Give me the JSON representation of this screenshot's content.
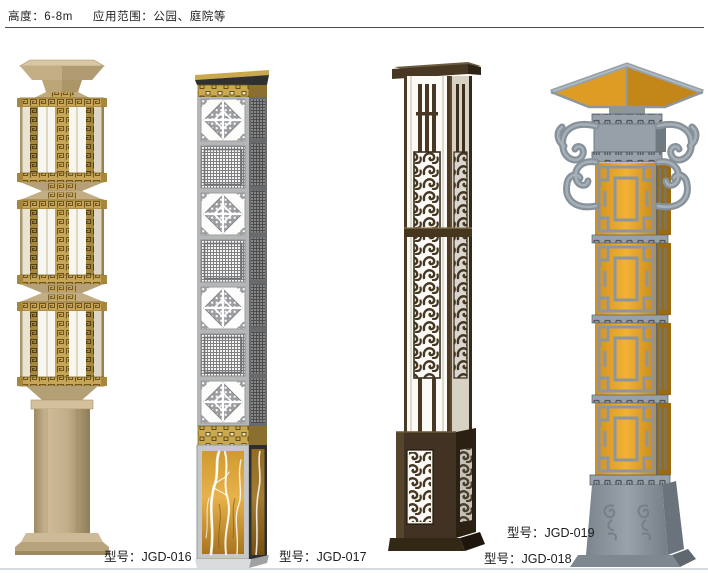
{
  "page": {
    "header": {
      "spec_text_height": "高度：6-8m",
      "spec_text_scope": "应用范围：公园、庭院等"
    }
  },
  "products": [
    {
      "model": "JGD-016",
      "label": "型号：JGD-016"
    },
    {
      "model": "JGD-017",
      "label": "型号：JGD-017"
    },
    {
      "model": "JGD-018",
      "label": "型号：JGD-018"
    },
    {
      "model": "JGD-019",
      "label": "型号：JGD-019"
    }
  ],
  "colors": {
    "gold_fret": "#c8a658",
    "tan_frame": "#c3ae87",
    "silver_frame": "#b4b6b8",
    "bronze_frame": "#453623",
    "amber_glass": "#e9a42d",
    "steel_gray": "#98a1a9",
    "marble_amber": "#e7b24a"
  }
}
